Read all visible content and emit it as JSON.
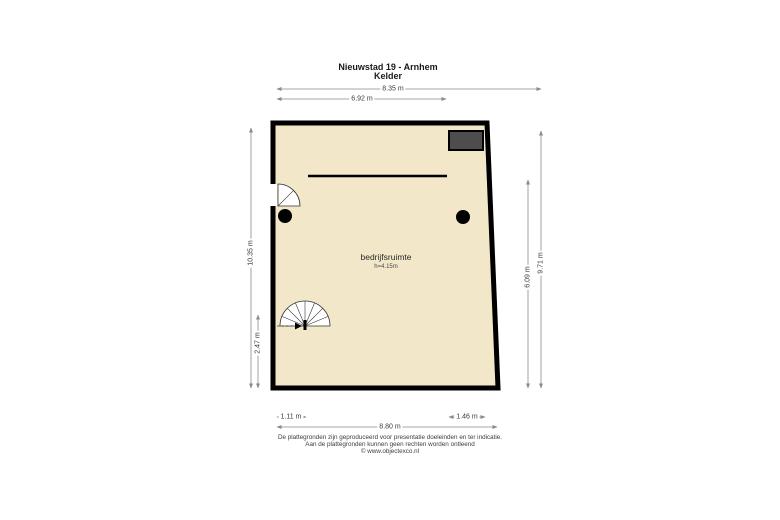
{
  "title": {
    "line1": "Nieuwstad 19 - Arnhem",
    "line2": "Kelder"
  },
  "plan": {
    "room_label": "bedrijfsruimte",
    "room_height": "h=4.15m",
    "floor_color": "#f2e7c8",
    "wall_color": "#000000",
    "dark_box_color": "#4d4d4d"
  },
  "dimensions": {
    "top_outer": "8.35 m",
    "top_inner": "6.92 m",
    "left_full": "10.35 m",
    "left_lower": "2.47 m",
    "right_inner": "6.09 m",
    "right_outer": "9.71 m",
    "bottom_left": "1.11 m",
    "bottom_right": "1.46 m",
    "bottom_full": "8.80 m"
  },
  "footer": {
    "line1": "De plattegronden zijn geproduceerd voor presentatie doeleinden en ter indicatie.",
    "line2": "Aan de plattegronden kunnen geen rechten worden ontleend",
    "line3": "© www.objectexco.nl"
  }
}
